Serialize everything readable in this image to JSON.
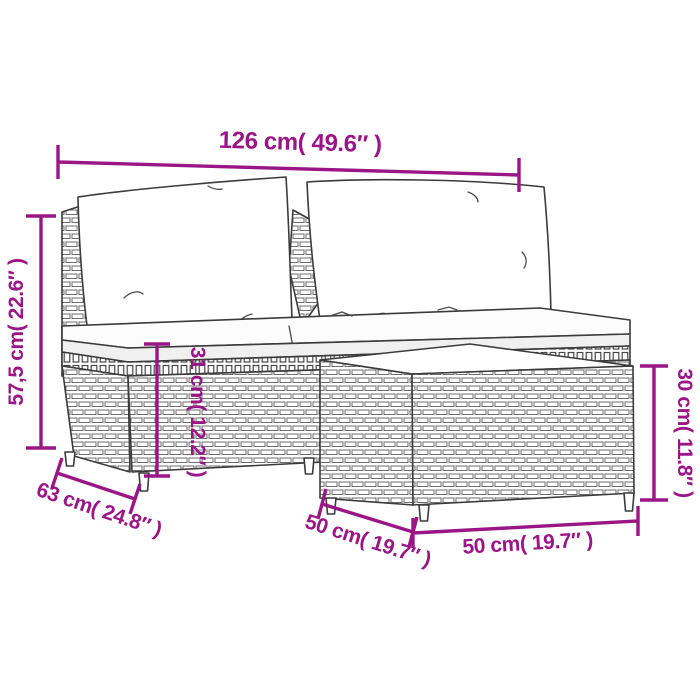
{
  "diagram": {
    "accent_color": "#9a1687",
    "line_art_color": "#3b3b3b",
    "background_color": "#ffffff",
    "furniture": {
      "sofa": "rattan-two-seat-sofa-with-back-pillows-and-seat-cushions",
      "table": "rattan-coffee-table"
    },
    "dimensions": {
      "overall_width": {
        "label": "126 cm( 49.6″ )",
        "cm": "126",
        "inches": "49.6"
      },
      "overall_height": {
        "label": "57,5 cm( 22.6″ )",
        "cm": "57,5",
        "inches": "22.6"
      },
      "seat_height": {
        "label": "31 cm( 12.2″ )",
        "cm": "31",
        "inches": "12.2"
      },
      "table_height": {
        "label": "30 cm( 11.8″ )",
        "cm": "30",
        "inches": "11.8"
      },
      "sofa_depth": {
        "label": "63 cm( 24.8″ )",
        "cm": "63",
        "inches": "24.8"
      },
      "table_depth": {
        "label": "50 cm( 19.7″ )",
        "cm": "50",
        "inches": "19.7"
      },
      "table_width": {
        "label": "50 cm( 19.7″ )",
        "cm": "50",
        "inches": "19.7"
      }
    }
  }
}
